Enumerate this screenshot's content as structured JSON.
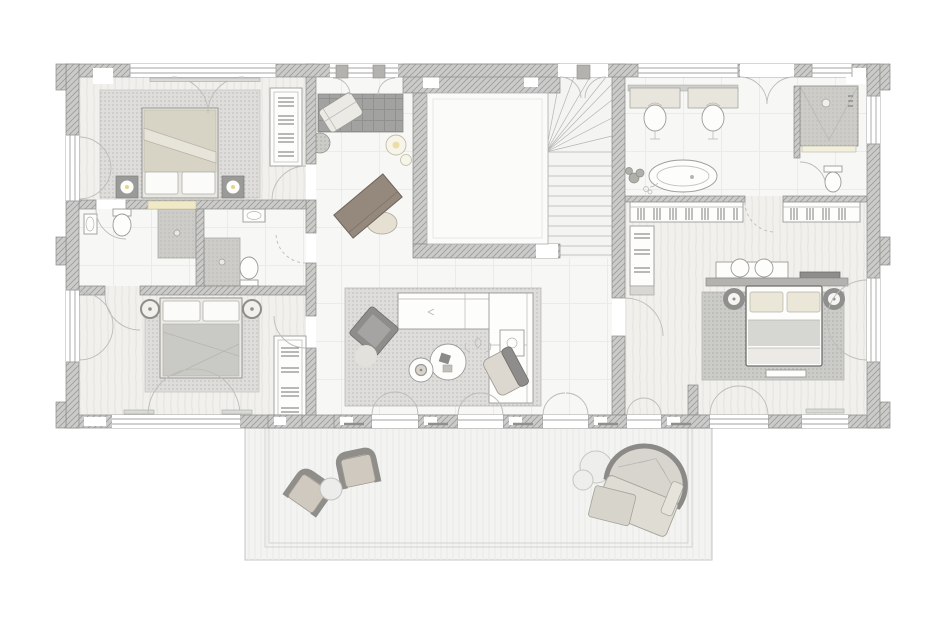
{
  "meta": {
    "type": "architectural-floor-plan",
    "view": "top-down",
    "contains_text": false
  },
  "palette": {
    "background": "#ffffff",
    "wall_fill": "#cbcbc9",
    "wall_hatch": "#9c9c9a",
    "wall_stroke": "#8a8a88",
    "floor": "#f7f7f5",
    "floor_grid": "#ebebe9",
    "carpet": "#f1f0ed",
    "carpet_stroke": "#e4e3df",
    "rug": "#dedddc",
    "rug_dot": "#b8b7b3",
    "rug_dark": "#a2a2a0",
    "rug_dark_line": "#90908e",
    "master_rug": "#cbcbc7",
    "master_rug_dot": "#a9a9a5",
    "furniture_fill": "#fdfdfc",
    "furniture_stroke": "#9b9b98",
    "duvet_beige": "#d7d3c5",
    "duvet_gray": "#c9c9c5",
    "pillow": "#fbfbf9",
    "desk_brown": "#95887c",
    "counter_yellow": "#efe9c6",
    "lamp_accent": "#e6d48a",
    "armchair_dark": "#8e8d8b",
    "outdoor_seat": "#cfc9c0",
    "terrace": "#f3f3f1",
    "terrace_frame": "#c9c9c6",
    "terrace_texture": "#e9e9e7",
    "shower_gray": "#cdccc9",
    "arc_stroke": "#bcbcb9",
    "win_line": "#a3a3a0",
    "wardrobe_tick": "#73736f",
    "headboard": "#b3b2af"
  },
  "plan": {
    "rooms": [
      {
        "name": "bedroom-left-top",
        "furniture": [
          "double-bed",
          "pillows",
          "folded-duvet",
          "nightstand-left",
          "nightstand-right",
          "table-lamps",
          "area-rug",
          "wardrobe"
        ]
      },
      {
        "name": "bathroom-left-top",
        "furniture": [
          "shower",
          "toilet",
          "washbasin",
          "vanity-counter"
        ]
      },
      {
        "name": "bathroom-left-bottom",
        "furniture": [
          "shower",
          "toilet",
          "washbasin"
        ]
      },
      {
        "name": "bedroom-left-bottom",
        "furniture": [
          "double-bed",
          "pillows",
          "bedside-lamps",
          "area-rug",
          "wardrobe",
          "french-door"
        ]
      },
      {
        "name": "central-hall",
        "furniture": [
          "chaise-longue",
          "dark-rug",
          "pouf",
          "side-tables",
          "writing-desk",
          "desk-chair",
          "stair-core-void",
          "winder-staircase",
          "l-shaped-sofa",
          "armchair",
          "coffee-tables",
          "lounge-chair",
          "plant",
          "wardrobe"
        ]
      },
      {
        "name": "master-bathroom",
        "furniture": [
          "double-vanity",
          "washbasin-left",
          "washbasin-right",
          "freestanding-bathtub",
          "plant",
          "shower",
          "toilet"
        ]
      },
      {
        "name": "dressing-area",
        "furniture": [
          "wardrobe-rail-left",
          "wardrobe-rail-right",
          "linen-closet",
          "bench",
          "cushions"
        ]
      },
      {
        "name": "master-bedroom",
        "furniture": [
          "double-bed",
          "pillows",
          "headboard-wall",
          "bedside-lamp-tables",
          "area-rug",
          "foot-bench",
          "console"
        ]
      },
      {
        "name": "terrace",
        "furniture": [
          "outdoor-armchair-1",
          "outdoor-armchair-2",
          "outdoor-side-table",
          "curved-outdoor-sofa",
          "round-tables"
        ]
      }
    ]
  }
}
